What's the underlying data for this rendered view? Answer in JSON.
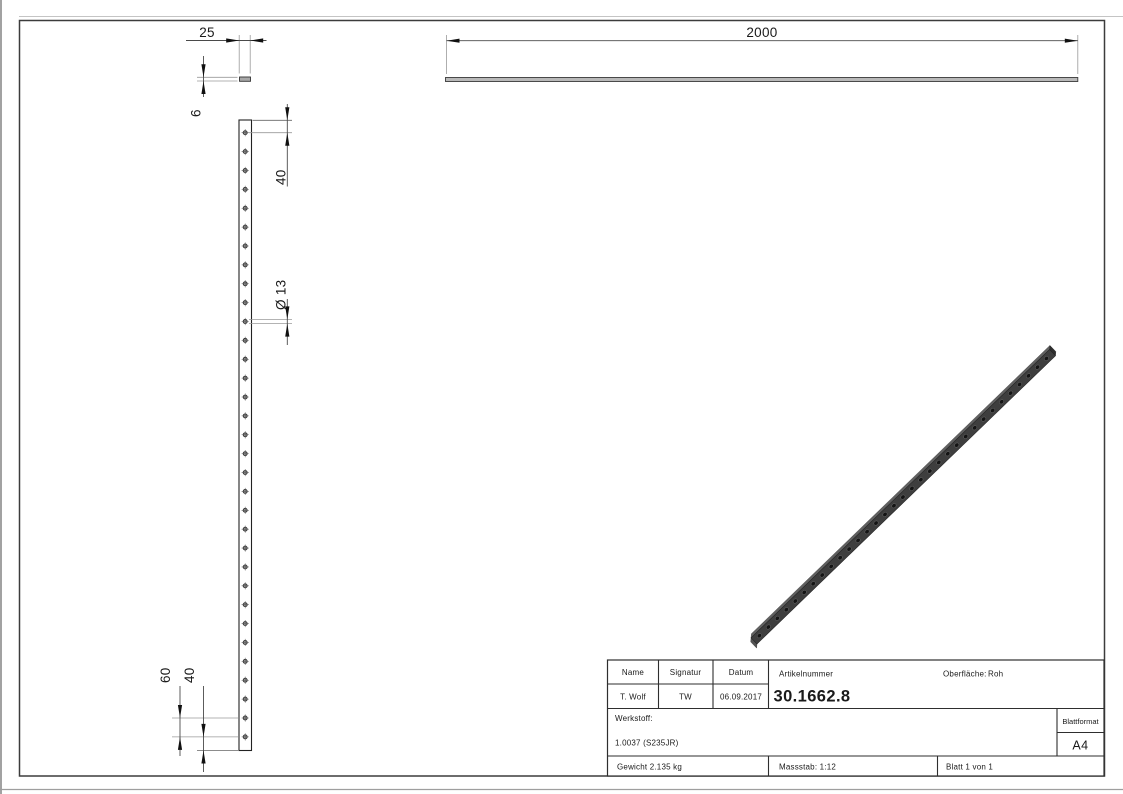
{
  "drawing": {
    "dimensions": {
      "length": "2000",
      "width": "25",
      "thickness": "6",
      "first_hole_offset": "40",
      "hole_diameter": "Ø 13",
      "hole_spacing": "60",
      "last_hole_offset": "40"
    },
    "holes": {
      "count": 33
    }
  },
  "title_block": {
    "name_header": "Name",
    "signature_header": "Signatur",
    "date_header": "Datum",
    "name": "T. Wolf",
    "signature": "TW",
    "date": "06.09.2017",
    "article_label": "Artikelnummer",
    "article_number": "30.1662.8",
    "surface_label": "Oberfläche:",
    "surface_value": "Roh",
    "material_label": "Werkstoff:",
    "material_value": "1.0037 (S235JR)",
    "weight": "Gewicht 2.135 kg",
    "scale": "Massstab: 1:12",
    "sheet": "Blatt 1 von 1",
    "format_label": "Blattformat",
    "format_value": "A4"
  },
  "colors": {
    "object_line": "#222222",
    "extension_line": "#9a9a9a",
    "dimension_line": "#4a4a4a",
    "arrow": "#111111",
    "section_fill": "#a8a8a8",
    "topview_fill": "#b9b9b9",
    "iso_body": "#3e3e3e",
    "iso_bevel": "#606060",
    "iso_end": "#2e2e2e",
    "iso_hole": "#141414"
  }
}
